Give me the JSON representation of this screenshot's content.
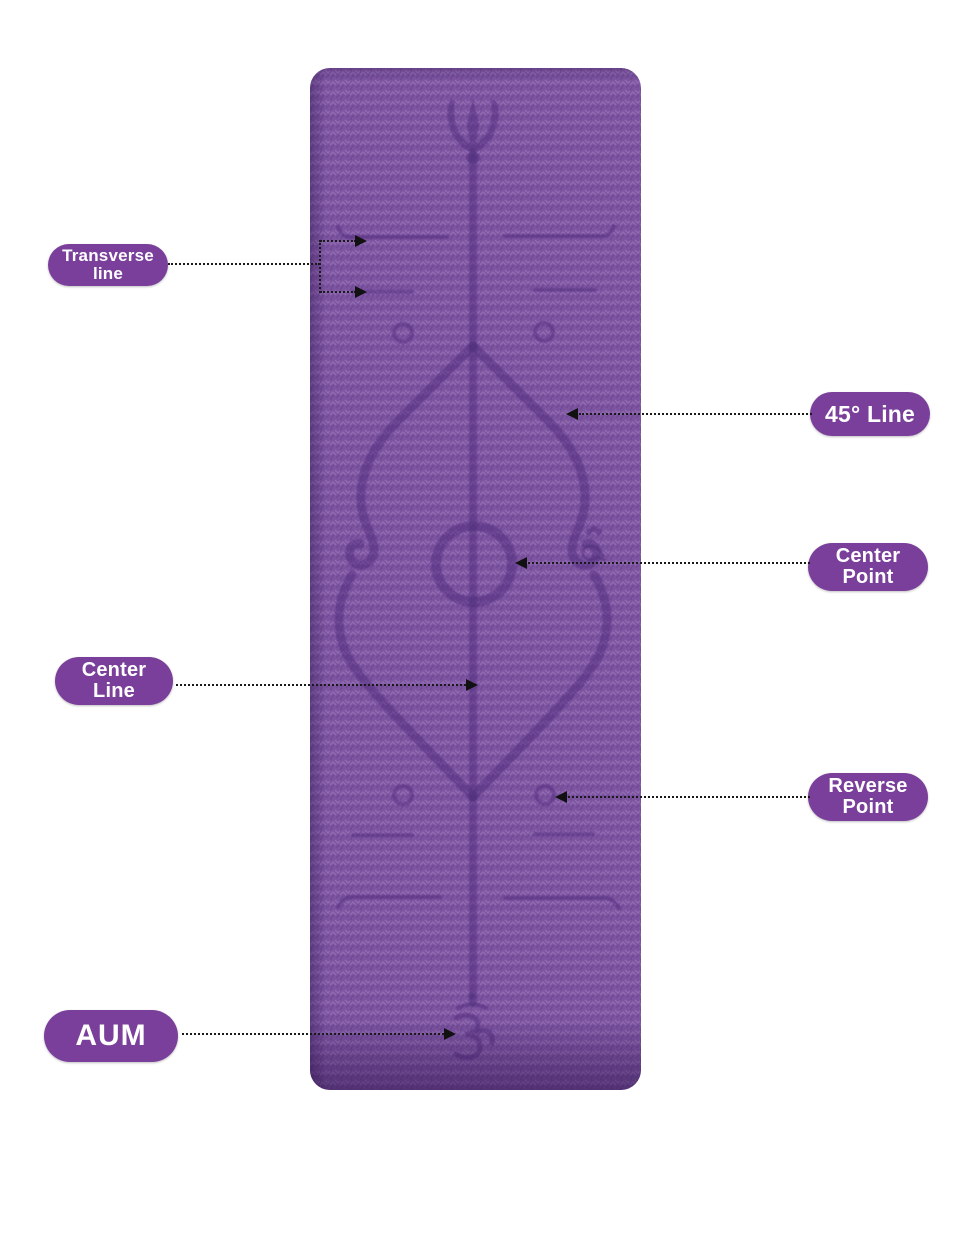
{
  "page": {
    "type": "product-annotation-infographic",
    "subject": "purple yoga mat with body alignment guide lines"
  },
  "mat": {
    "base_color": "#7c54a0",
    "texture_light": "#956fb5",
    "texture_dark": "#6a4492",
    "marking_color": "#4e2e7c",
    "top_symbol": "trident-icon",
    "bottom_symbol": "om-icon"
  },
  "callouts": {
    "transverse_line": {
      "line1": "Transverse",
      "line2": "line"
    },
    "line_45": {
      "label": "45° Line"
    },
    "center_point": {
      "line1": "Center",
      "line2": "Point"
    },
    "center_line": {
      "line1": "Center",
      "line2": "Line"
    },
    "reverse_point": {
      "line1": "Reverse",
      "line2": "Point"
    },
    "aum": {
      "label": "AUM"
    }
  },
  "colors": {
    "label_bg": "#7a3f9b",
    "label_text": "#ffffff",
    "connector": "#1a1a1a",
    "background": "#ffffff"
  }
}
